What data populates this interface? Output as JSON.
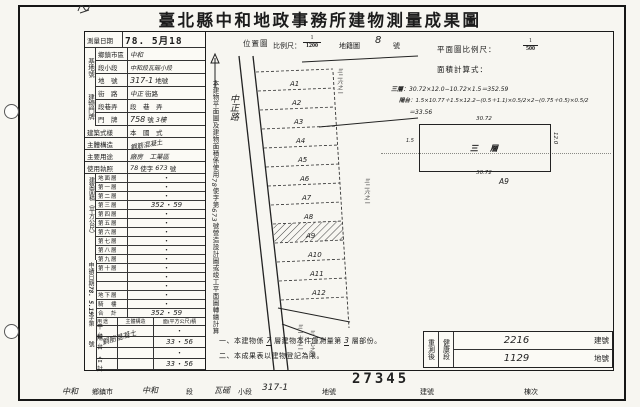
{
  "page": {
    "title": "臺北縣中和地政事務所建物測量成果圖",
    "stamp_number": "27345"
  },
  "header": {
    "survey_date_label": "測量日期",
    "survey_date": "78. 5月18",
    "location_map_label": "位置圖",
    "scale_label": "比例尺：",
    "scale_num": "1",
    "scale_den": "1200",
    "cadastral_label": "地籍圖",
    "cadastral_no": "8",
    "cadastral_suffix": "號",
    "plan_scale_label": "平面圖比例尺：",
    "plan_scale_num": "1",
    "plan_scale_den": "500",
    "area_formula_label": "面積計算式："
  },
  "site": {
    "section_label": "基地號",
    "rows": [
      {
        "label": "鄉鎮市區",
        "hand": "中和",
        "suffix": ""
      },
      {
        "label": "段小段",
        "hand": "中和段瓦磘小段",
        "suffix": ""
      },
      {
        "label": "地　號",
        "hand": "317-1",
        "suffix": "地號"
      }
    ]
  },
  "door": {
    "section_label": "建物門牌",
    "rows": [
      {
        "label": "街　路",
        "hand": "中正",
        "suffix": "街路"
      },
      {
        "label": "段巷弄",
        "hand": "",
        "suffix": "段　巷　弄"
      },
      {
        "label": "門　牌",
        "hand": "758",
        "suffix": "號",
        "hand2": "3樓"
      }
    ]
  },
  "info": {
    "style_label": "建築式樣",
    "style_value": "本　國　式",
    "structure_label": "主體構造",
    "structure_hand": "鋼筋混凝土",
    "usage_label": "主要用途",
    "usage_hand": "廠房　工業區",
    "license_label": "使用執照",
    "license_hand1": "78",
    "license_mid": "使字",
    "license_hand2": "673",
    "license_suffix": "號"
  },
  "area": {
    "section_label": "建築面積（平方公尺）",
    "dot": "・",
    "rows": [
      {
        "label": "地面層",
        "l": "",
        "r": ""
      },
      {
        "label": "第一層",
        "l": "",
        "r": ""
      },
      {
        "label": "第二層",
        "l": "",
        "r": ""
      },
      {
        "label": "第三層",
        "l": "352",
        "r": "59"
      },
      {
        "label": "第四層",
        "l": "",
        "r": ""
      },
      {
        "label": "第五層",
        "l": "",
        "r": ""
      },
      {
        "label": "第六層",
        "l": "",
        "r": ""
      },
      {
        "label": "第七層",
        "l": "",
        "r": ""
      },
      {
        "label": "第八層",
        "l": "",
        "r": ""
      },
      {
        "label": "第九層",
        "l": "",
        "r": ""
      },
      {
        "label": "第十層",
        "l": "",
        "r": ""
      },
      {
        "label": "",
        "l": "",
        "r": ""
      },
      {
        "label": "",
        "l": "",
        "r": ""
      },
      {
        "label": "地下層",
        "l": "",
        "r": ""
      },
      {
        "label": "騎　樓",
        "l": "",
        "r": ""
      },
      {
        "label": "合　計",
        "l": "352",
        "r": "59"
      }
    ]
  },
  "apply": {
    "label": "申請日期",
    "stamp": "78. 5.19",
    "no_label": "字第",
    "no_suffix": "號"
  },
  "annex": {
    "header": {
      "usage": "用途",
      "structure": "主體構造",
      "area": "面(平方公尺)積"
    },
    "structure_hand": "鋼筋混凝土",
    "rows": [
      {
        "usage": "平　台",
        "l": "",
        "r": ""
      },
      {
        "usage": "陽　台",
        "l": "33",
        "r": "56"
      },
      {
        "usage": "",
        "l": "",
        "r": ""
      },
      {
        "usage": "合　計",
        "l": "33",
        "r": "56"
      }
    ]
  },
  "side_note": {
    "p1": "本建物平面圖及建物面積係使用",
    "h1": "78",
    "p2": "使字第",
    "h2": "673",
    "p3": "號營造設計圖或竣工平面圖轉繪計算"
  },
  "map": {
    "road_label": "中正路",
    "parcels": [
      "A1",
      "A2",
      "A3",
      "A4",
      "A5",
      "A6",
      "A7",
      "A8",
      "A9",
      "A10",
      "A11",
      "A12"
    ],
    "annotations": [
      "三二六之一",
      "三二六之一",
      "三一七之一",
      "三一七之二"
    ]
  },
  "plan": {
    "floor_label": "三層",
    "floor_formula": "30.72×12.0−10.72×1.5＝352.59",
    "balcony_label": "陽台",
    "balcony_formula": "1.5×10.77＋1.5×12.2−(0.5＋1.1)×0.5/2×2−(0.75＋0.5)×0.5/2",
    "balcony_result": "＝33.56",
    "rect_label": "三　層",
    "dim_top": "30.72",
    "dim_bottom": "30.72",
    "dim_right": "12.0",
    "dim_left": "1.5",
    "ref": "A9"
  },
  "notes": {
    "n1_no": "一、",
    "n1_t1": "本建物係",
    "n1_h1": "7",
    "n1_t2": "層建物本件僅測量第",
    "n1_h2": "3",
    "n1_t3": "層部份。",
    "n2_no": "二、",
    "n2_t1": "本成果表以建物登記為限。"
  },
  "resurvey": {
    "label": "重測後",
    "section": "健康段",
    "rows": [
      {
        "hand": "2216",
        "suffix": "建號"
      },
      {
        "hand": "1129",
        "suffix": "地號"
      }
    ]
  },
  "footer": {
    "hand_city": "中和",
    "label_city": "鄉鎮市",
    "hand_sec": "中和",
    "label_sec": "段",
    "hand_sub": "瓦磘",
    "label_sub": "小段",
    "hand_lot": "317-1",
    "label_lot": "地號",
    "label_bno": "建號",
    "label_unit": "棟次"
  }
}
